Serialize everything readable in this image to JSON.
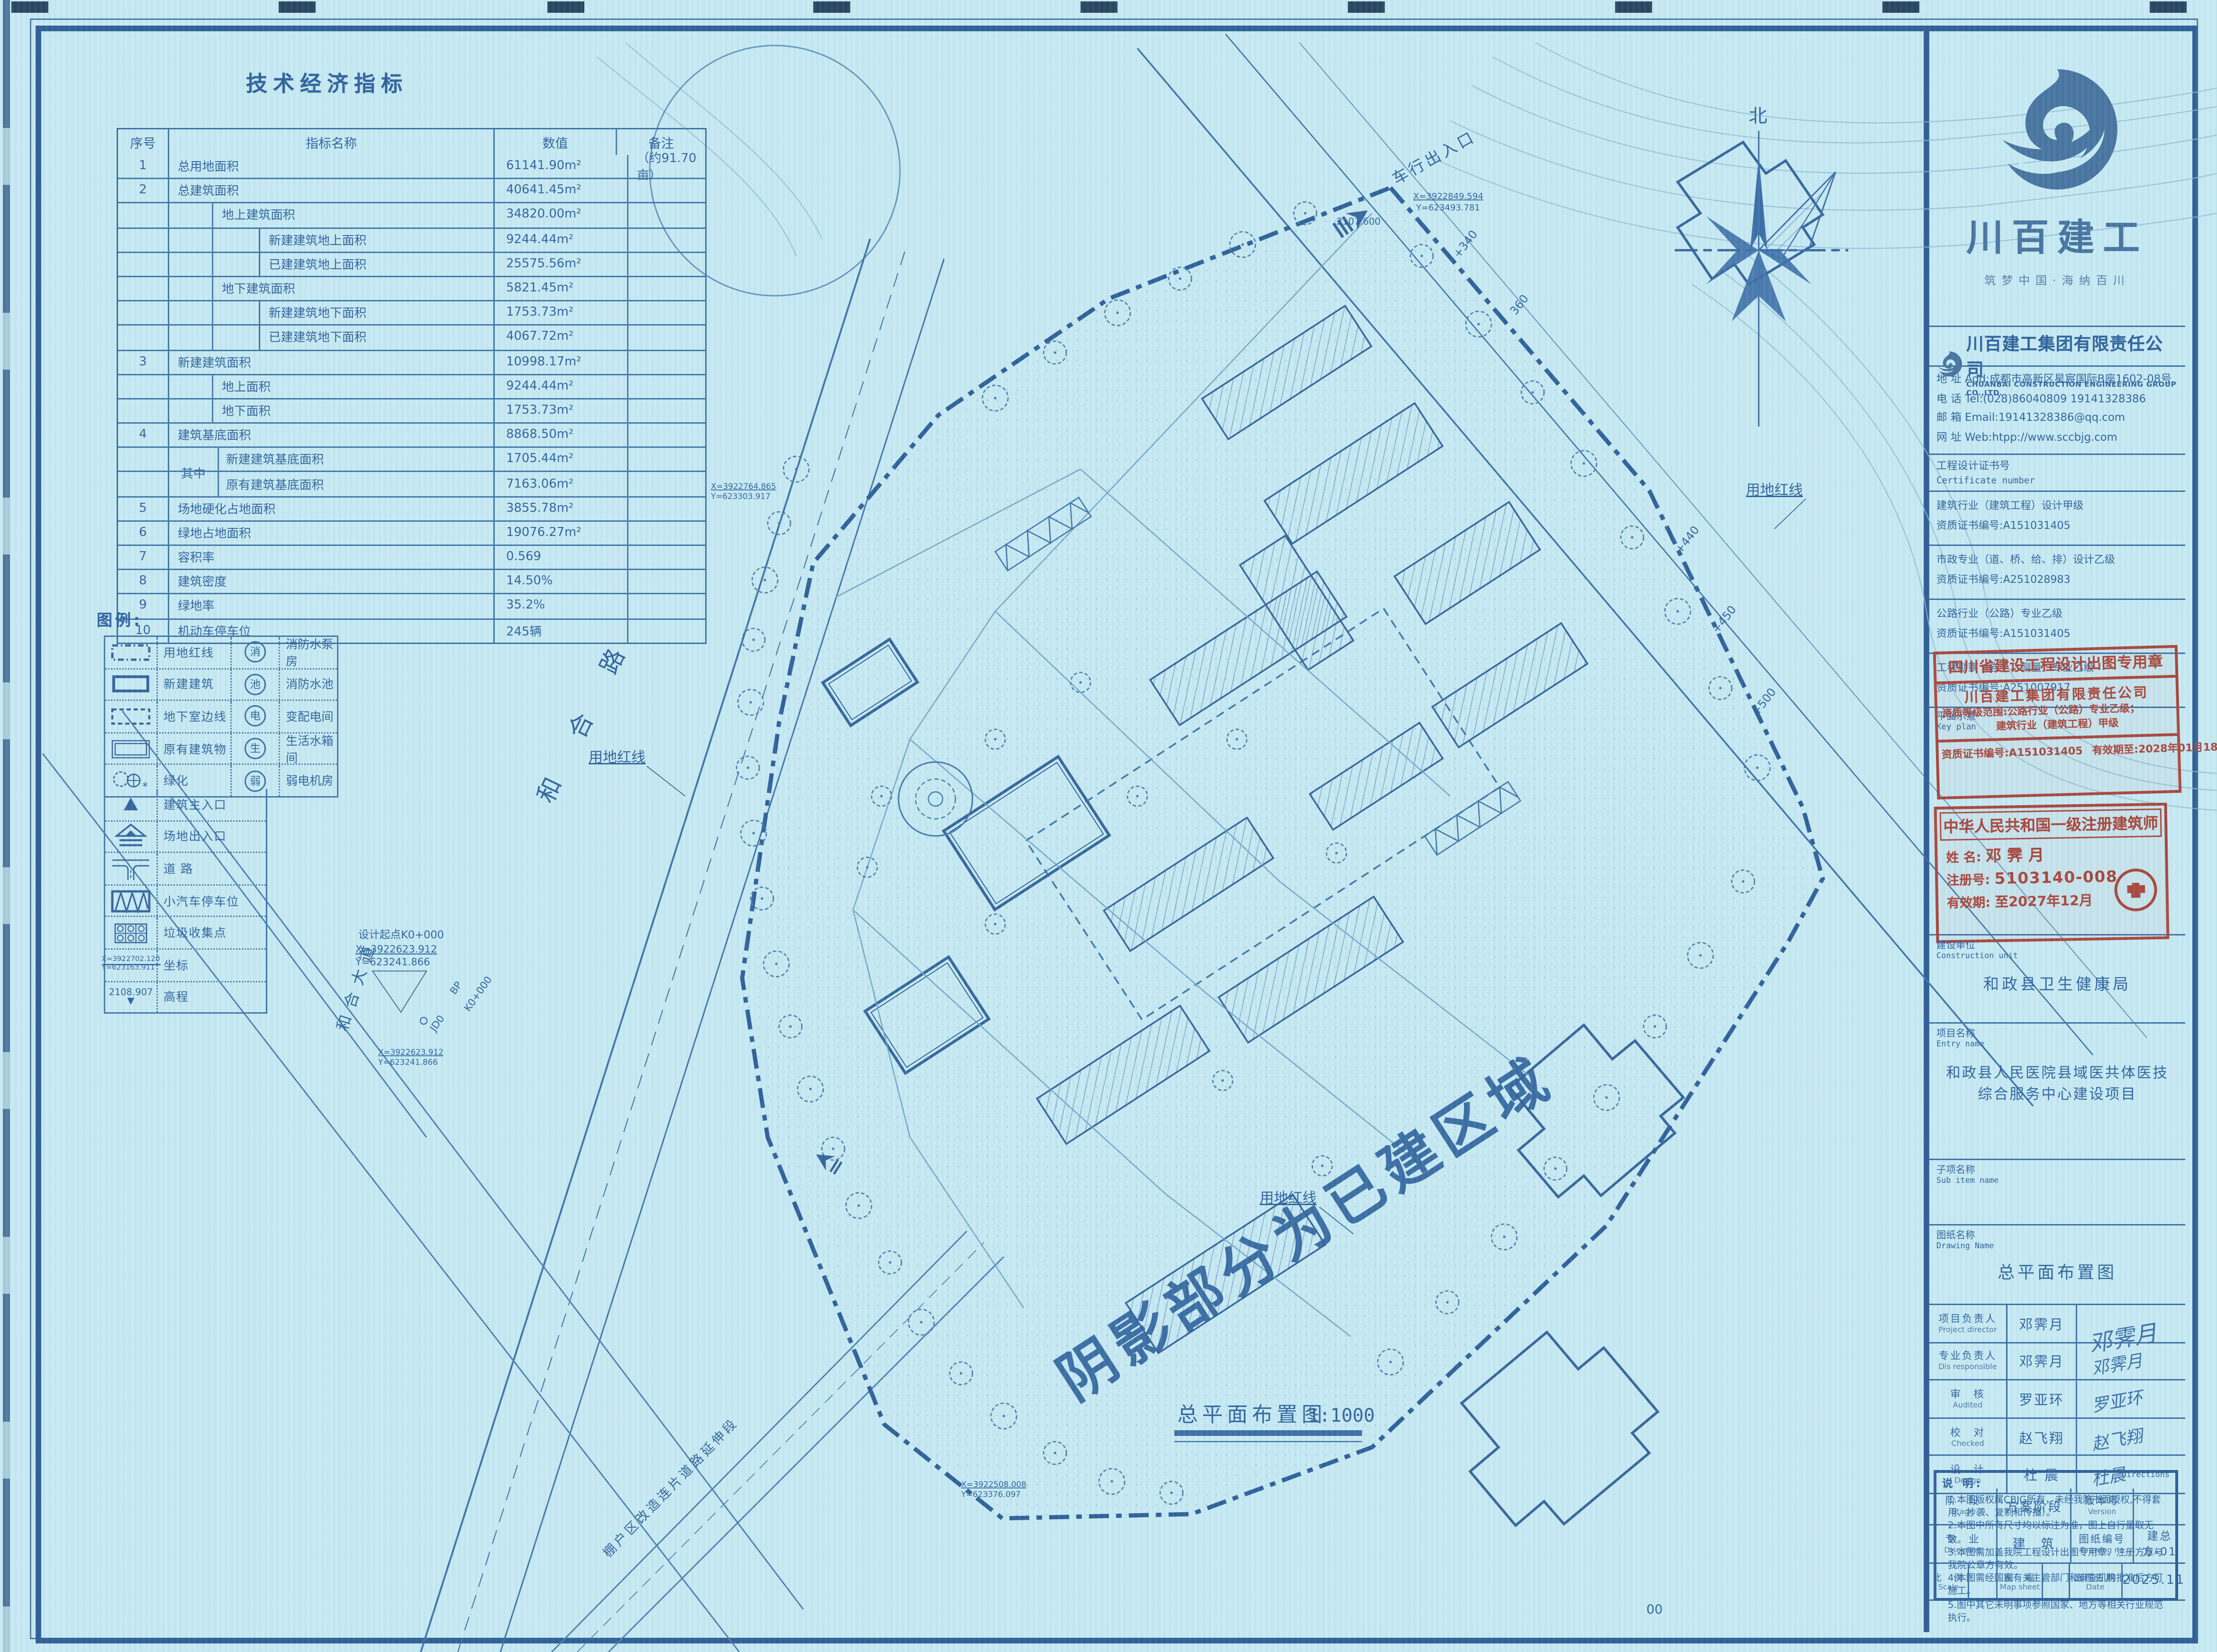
{
  "colors": {
    "paper": "#c6e9f2",
    "ink": "#2f639c",
    "frame": "#2e5e94",
    "stamp_red": "#a8463c"
  },
  "table": {
    "title": "技术经济指标",
    "headers": {
      "no": "序号",
      "name": "指标名称",
      "value": "数值",
      "note": "备注"
    },
    "group_label": "其中",
    "rows": [
      {
        "no": "1",
        "name": "总用地面积",
        "value": "61141.90m²",
        "note": "（约91.70亩）",
        "indent": 0,
        "group": false
      },
      {
        "no": "2",
        "name": "总建筑面积",
        "value": "40641.45m²",
        "note": "",
        "indent": 0,
        "group": false
      },
      {
        "no": "",
        "name": "地上建筑面积",
        "value": "34820.00m²",
        "note": "",
        "indent": 1,
        "group": false
      },
      {
        "no": "",
        "name": "新建建筑地上面积",
        "value": "9244.44m²",
        "note": "",
        "indent": 2,
        "group": false
      },
      {
        "no": "",
        "name": "已建建筑地上面积",
        "value": "25575.56m²",
        "note": "",
        "indent": 2,
        "group": false
      },
      {
        "no": "",
        "name": "地下建筑面积",
        "value": "5821.45m²",
        "note": "",
        "indent": 1,
        "group": false
      },
      {
        "no": "",
        "name": "新建建筑地下面积",
        "value": "1753.73m²",
        "note": "",
        "indent": 2,
        "group": false
      },
      {
        "no": "",
        "name": "已建建筑地下面积",
        "value": "4067.72m²",
        "note": "",
        "indent": 2,
        "group": false
      },
      {
        "no": "3",
        "name": "新建建筑面积",
        "value": "10998.17m²",
        "note": "",
        "indent": 0,
        "group": false
      },
      {
        "no": "",
        "name": "地上面积",
        "value": "9244.44m²",
        "note": "",
        "indent": 1,
        "group": false
      },
      {
        "no": "",
        "name": "地下面积",
        "value": "1753.73m²",
        "note": "",
        "indent": 1,
        "group": false
      },
      {
        "no": "4",
        "name": "建筑基底面积",
        "value": "8868.50m²",
        "note": "",
        "indent": 0,
        "group": false
      },
      {
        "no": "",
        "name": "新建建筑基底面积",
        "value": "1705.44m²",
        "note": "",
        "indent": 2,
        "group": true
      },
      {
        "no": "",
        "name": "原有建筑基底面积",
        "value": "7163.06m²",
        "note": "",
        "indent": 2,
        "group": true
      },
      {
        "no": "5",
        "name": "场地硬化占地面积",
        "value": "3855.78m²",
        "note": "",
        "indent": 0,
        "group": false
      },
      {
        "no": "6",
        "name": "绿地占地面积",
        "value": "19076.27m²",
        "note": "",
        "indent": 0,
        "group": false
      },
      {
        "no": "7",
        "name": "容积率",
        "value": "0.569",
        "note": "",
        "indent": 0,
        "group": false
      },
      {
        "no": "8",
        "name": "建筑密度",
        "value": "14.50%",
        "note": "",
        "indent": 0,
        "group": false
      },
      {
        "no": "9",
        "name": "绿地率",
        "value": "35.2%",
        "note": "",
        "indent": 0,
        "group": false
      },
      {
        "no": "10",
        "name": "机动车停车位",
        "value": "245辆",
        "note": "",
        "indent": 0,
        "group": false
      }
    ]
  },
  "legend": {
    "title": "图例:",
    "pairs": [
      {
        "sym": "redline",
        "label": "用地红线",
        "badge": "消",
        "badge_label": "消防水泵房"
      },
      {
        "sym": "newbuild",
        "label": "新建建筑",
        "badge": "池",
        "badge_label": "消防水池"
      },
      {
        "sym": "basement",
        "label": "地下室边线",
        "badge": "电",
        "badge_label": "变配电间"
      },
      {
        "sym": "existing",
        "label": "原有建筑物",
        "badge": "生",
        "badge_label": "生活水箱间"
      },
      {
        "sym": "green",
        "label": "绿化",
        "badge": "弱",
        "badge_label": "弱电机房"
      }
    ],
    "singles": [
      {
        "sym": "main-entry",
        "label": "建筑主入口"
      },
      {
        "sym": "site-entry",
        "label": "场地出入口"
      },
      {
        "sym": "road",
        "label": "道 路"
      },
      {
        "sym": "parking",
        "label": "小汽车停车位"
      },
      {
        "sym": "trash",
        "label": "垃圾收集点"
      },
      {
        "sym": "coord",
        "label": "坐标",
        "x": "X=3922702.120",
        "y": "Y=623163.911"
      },
      {
        "sym": "elev",
        "label": "高程",
        "value": "2108.907"
      }
    ]
  },
  "plan": {
    "north": "北",
    "road_hehe": "和 合 路",
    "road_hehedadao": "和合大道",
    "road_bottom": "棚户区改造连片道路延伸段",
    "redline": "用地红线",
    "entrance": "车行出入口",
    "entrance_x": "X=3922849.594",
    "entrance_y": "Y=623493.781",
    "entrance_elev": "2107.600",
    "start_label": "设计起点K0+000",
    "start_x": "X=3922623.912",
    "start_y": "Y=623241.866",
    "bp": "BP",
    "k0": "K0+000",
    "jd0": "JD0",
    "coord_left_x": "X=3922764.865",
    "coord_left_y": "Y=623303.917",
    "coord_bottom_x": "X=3922508.008",
    "coord_bottom_y": "Y=623376.097",
    "ch_340": "+340",
    "ch_360": "360",
    "ch_440": "+440",
    "ch_450": "+450",
    "ch_500": "+500",
    "big_note": "阴影部分为已建区域",
    "title": "总平面布置图",
    "scale": "1:1000",
    "page_no": "00"
  },
  "titleblock": {
    "logo": {
      "name": "川百建工",
      "slogan": "筑梦中国·海纳百川"
    },
    "company": {
      "cn": "川百建工集团有限责任公司",
      "en": "CHUANBAI CONSTRUCTION ENGINEERING GROUP CO.,LTD.",
      "addr": "地  址 Add:成都市高新区星宸国际B座1602-08号",
      "tel": "电  话 Tel:(028)86040809  19141328386",
      "email": "邮  箱 Email:19141328386@qq.com",
      "web": "网  址 Web:htpp://www.sccbjg.com"
    },
    "cert": {
      "cn": "工程设计证书号",
      "en": "Certificate number"
    },
    "quals": [
      {
        "l1": "建筑行业（建筑工程）设计甲级",
        "l2": "资质证书编号:A151031405"
      },
      {
        "l1": "市政专业（道、桥、给、排）设计乙级",
        "l2": "资质证书编号:A251028983"
      },
      {
        "l1": "公路行业（公路）专业乙级",
        "l2": "资质证书编号:A151031405"
      },
      {
        "l1": "工程勘察（岩土、测量）专业乙级",
        "l2": "资质证书编号:A251007917"
      }
    ],
    "keyplan": {
      "cn": "平面示意",
      "en": "Key plan"
    },
    "stamp1": {
      "header": "四川省建设工程设计出图专用章",
      "company": "川百建工集团有限责任公司",
      "scope1": "资质等级范围:公路行业（公路）专业乙级；",
      "scope2": "建筑行业（建筑工程）甲级",
      "cert_no": "资质证书编号:A151031405",
      "valid": "有效期至:2028年01月18日"
    },
    "stamp2": {
      "header": "中华人民共和国一级注册建筑师",
      "name_label": "姓  名:",
      "name": "邓霁月",
      "reg_label": "注册号:",
      "reg": "5103140-008",
      "valid_label": "有效期:",
      "valid": "至2027年12月"
    },
    "sections": {
      "unit_cn": "建设单位",
      "unit_en": "Construction unit",
      "unit_value": "和政县卫生健康局",
      "entry_cn": "项目名称",
      "entry_en": "Entry name",
      "entry_line1": "和政县人民医院县域医共体医技",
      "entry_line2": "综合服务中心建设项目",
      "sub_cn": "子项名称",
      "sub_en": "Sub item name",
      "sub_value": "",
      "drawing_cn": "图纸名称",
      "drawing_en": "Drawing Name",
      "drawing_value": "总平面布置图"
    },
    "signatures": [
      {
        "cn": "项目负责人",
        "en": "Project director",
        "name": "邓霁月",
        "sig": ""
      },
      {
        "cn": "专业负责人",
        "en": "Dis responsible",
        "name": "邓霁月",
        "sig": "邓霁月"
      },
      {
        "cn": "审　核",
        "en": "Audited",
        "name": "罗亚环",
        "sig": "罗亚环"
      },
      {
        "cn": "校　对",
        "en": "Checked",
        "name": "赵飞翔",
        "sig": "赵飞翔"
      },
      {
        "cn": "设　计",
        "en": "Design",
        "name": "杜 晨",
        "sig": "杜晨"
      }
    ],
    "meta": {
      "stage_cn": "阶　段",
      "stage_en": "Stage",
      "stage_value": "方案阶段",
      "version_cn": "版本号",
      "version_en": "Version",
      "version_value": "",
      "discipline_cn": "专　业",
      "discipline_en": "Discipline",
      "discipline_value": "建　筑",
      "drawno_cn": "图纸编号",
      "drawno_en": "Drawing no",
      "drawno_value": "建总方-01",
      "scale_cn": "比　例",
      "scale_en": "Scale",
      "scale_value": "",
      "sheet_cn": "图　幅",
      "sheet_en": "Map sheet",
      "sheet_value": "",
      "date_cn": "出图日期",
      "date_en": "Date",
      "date_value": "2025.11"
    },
    "notes": {
      "label": "说 明:",
      "directions": "Directions",
      "items": [
        "1.本图版权属CBJG所有，未经我院书面授权,不得套用、抄袭、复制和传播）。",
        "2.本图中所有尺寸均以标注为准，图上自行量取无效。",
        "3.本图需加盖我院工程设计出图专用章、注册方章与我院公章方有效。",
        "4.本图需经国家有关主管部门和审查机构批准后方可施工。",
        "5.图中其它未明事项参照国家、地方等相关行业规范执行。"
      ]
    }
  }
}
